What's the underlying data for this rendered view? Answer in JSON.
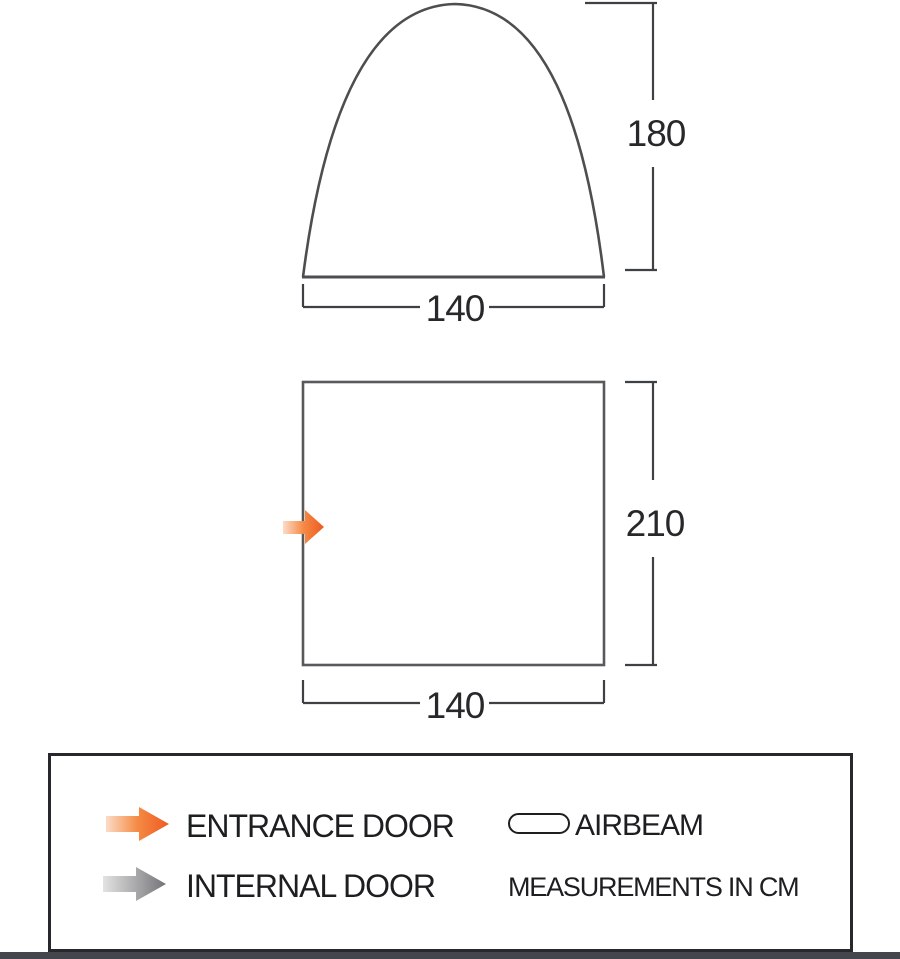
{
  "diagram": {
    "front_view": {
      "height_cm": "180",
      "width_cm": "140"
    },
    "floor_plan": {
      "depth_cm": "210",
      "width_cm": "140"
    }
  },
  "legend": {
    "entrance_door_label": "ENTRANCE DOOR",
    "internal_door_label": "INTERNAL DOOR",
    "airbeam_label": "AIRBEAM",
    "measurements_note": "MEASUREMENTS IN CM"
  },
  "colors": {
    "entrance_arrow": "#ee5a21",
    "entrance_arrow_mid": "#f58a45",
    "entrance_arrow_light": "#fbdcc6",
    "internal_arrow": "#737477",
    "internal_arrow_light": "#e3e3e3",
    "diagram_line": "#4d4e50",
    "dimension_line": "#3f4043",
    "text": "#1d1e20"
  }
}
